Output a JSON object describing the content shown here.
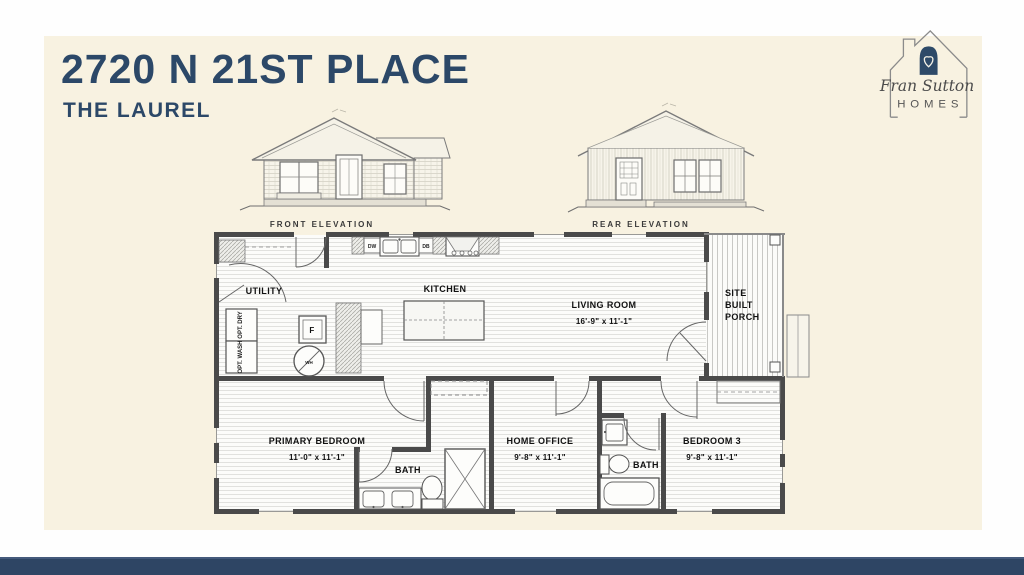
{
  "colors": {
    "navy": "#2c4868",
    "cream": "#f8f2e1",
    "footer": "#2e4564",
    "wall": "#4a4a4a"
  },
  "header": {
    "title": "2720 N 21ST PLACE",
    "subtitle": "THE LAUREL"
  },
  "logo": {
    "script": "Fran Sutton",
    "homes": "HOMES"
  },
  "elevations": {
    "front_label": "FRONT ELEVATION",
    "rear_label": "REAR ELEVATION"
  },
  "plan": {
    "rooms": {
      "utility": {
        "name": "UTILITY"
      },
      "kitchen": {
        "name": "KITCHEN"
      },
      "living": {
        "name": "LIVING ROOM",
        "dims": "16'-9\" x  11'-1\""
      },
      "porch": {
        "line1": "SITE",
        "line2": "BUILT",
        "line3": "PORCH"
      },
      "primary": {
        "name": "PRIMARY BEDROOM",
        "dims": "11'-0\" x  11'-1\""
      },
      "bath1": {
        "name": "BATH"
      },
      "office": {
        "name": "HOME OFFICE",
        "dims": "9'-8\" x  11'-1\""
      },
      "bath2": {
        "name": "BATH"
      },
      "bedroom3": {
        "name": "BEDROOM 3",
        "dims": "9'-8\" x  11'-1\""
      }
    },
    "appliances": {
      "dw": "DW",
      "db": "DB",
      "furnace": "F",
      "water_heater": "WH",
      "opt_dry": "OPT. DRY",
      "opt_wash": "OPT. WASH"
    }
  }
}
